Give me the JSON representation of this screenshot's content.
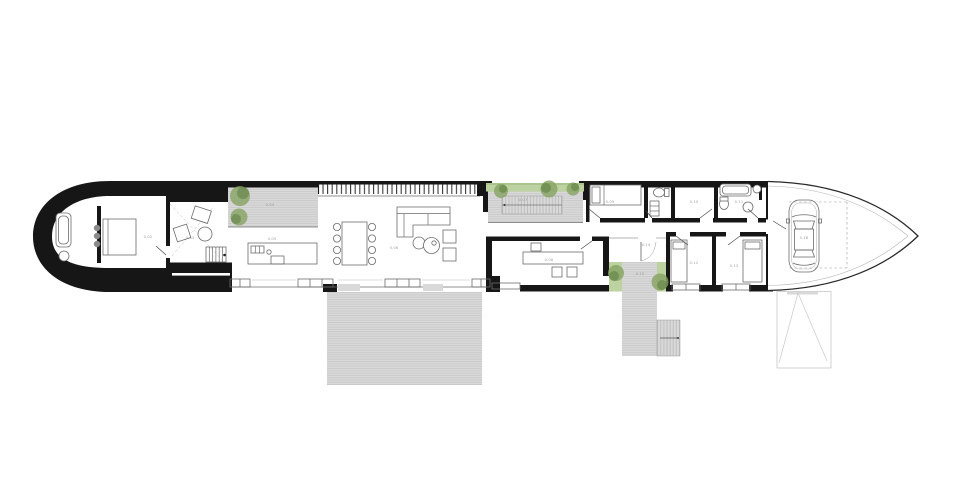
{
  "plan": {
    "type": "architectural-floor-plan",
    "description": "Long narrow boat-shaped single-storey house plan with rounded west cap, pointed east bow carport, decks and courtyards",
    "colors": {
      "wall": "#161616",
      "deck_fill": "#d9d9d9",
      "deck_line": "#c2c2c2",
      "grass": "#bcd2a0",
      "tree_light": "#86a363",
      "tree_dark": "#5c7d41",
      "furniture_line": "#6b6b6b",
      "bow_line": "#2a2a2a",
      "label_text": "#9a9a9a"
    },
    "rooms": {
      "cap_bedroom": {
        "label": "0.02"
      },
      "sitting": {
        "label": "0.03"
      },
      "terrace_west": {
        "label": "0.04"
      },
      "kitchen": {
        "label": "0.05"
      },
      "living": {
        "label": "0.06"
      },
      "court_north": {
        "label": "0.07"
      },
      "study": {
        "label": "0.08"
      },
      "bedroom_2": {
        "label": "0.09"
      },
      "robe": {
        "label": "0.10"
      },
      "bathroom_2": {
        "label": "0.11"
      },
      "bedroom_3": {
        "label": "0.12"
      },
      "bedroom_4": {
        "label": "0.13"
      },
      "entry": {
        "label": "0.14"
      },
      "porch": {
        "label": "0.15"
      },
      "carport": {
        "label": "0.16"
      }
    }
  }
}
